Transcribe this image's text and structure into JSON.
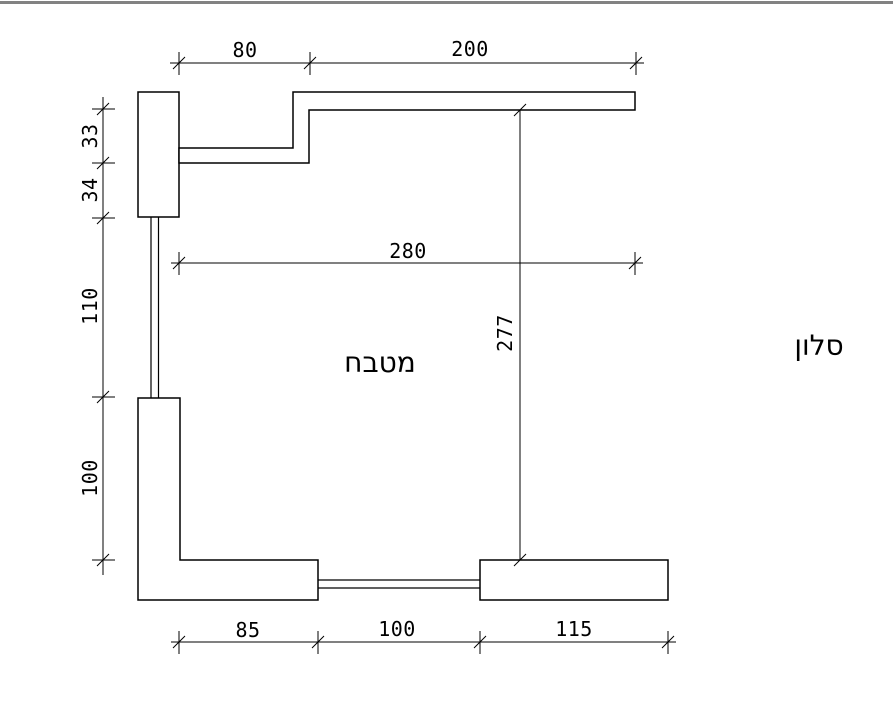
{
  "page": {
    "background": "#ffffff",
    "line_color": "#000000",
    "top_rule_color": "#808080"
  },
  "plan": {
    "room_labels": {
      "kitchen": "מטבח",
      "living_room": "סלון"
    },
    "dimensions": {
      "top": {
        "segments": [
          "80",
          "200"
        ]
      },
      "left": {
        "segments": [
          "33",
          "34",
          "110",
          "100"
        ]
      },
      "width_overall": "280",
      "height_overall": "277",
      "bottom": {
        "segments": [
          "85",
          "100",
          "115"
        ]
      }
    }
  }
}
